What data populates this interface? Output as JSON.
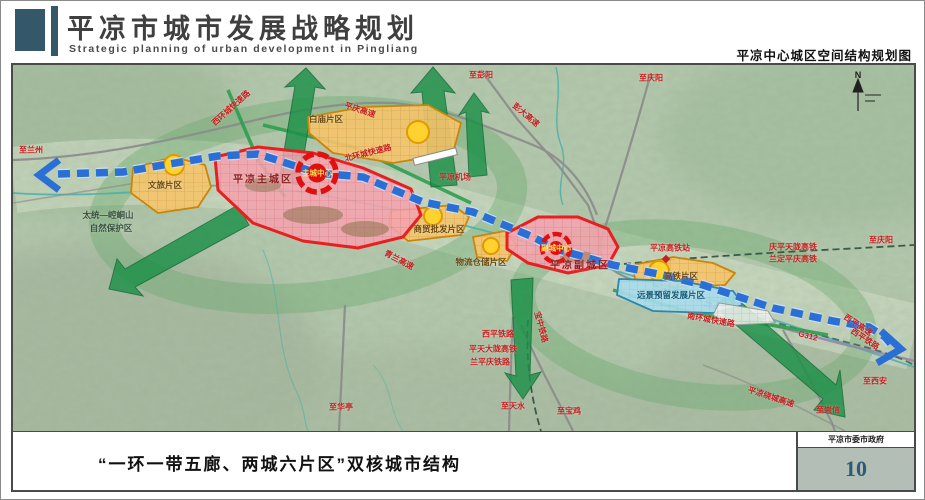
{
  "header": {
    "title": "平凉市城市发展战略规划",
    "subtitle": "Strategic planning of urban development in Pingliang",
    "map_title": "平凉中心城区空间结构规划图"
  },
  "footer": {
    "caption": "“一环一带五廊、两城六片区”双核城市结构",
    "organization": "平凉市委市政府",
    "page_number": "10"
  },
  "map": {
    "colors": {
      "header_accent": "#35576a",
      "terrain_green": "#b5c9ae",
      "corridor_green": "#1d9048",
      "axis_blue": "#2a6fd6",
      "core_red": "#e01010",
      "zone_orange": "#f6c46b",
      "zone_pink": "#f2a3ad",
      "zone_lightblue": "#a8dcec",
      "page_number_color": "#2c5a78"
    },
    "labels": [
      {
        "text": "至兰州",
        "x": 18,
        "y": 85,
        "cls": "r"
      },
      {
        "text": "至彭阳",
        "x": 468,
        "y": 10,
        "cls": "r"
      },
      {
        "text": "至庆阳",
        "x": 638,
        "y": 13,
        "cls": "r"
      },
      {
        "text": "至庆阳",
        "x": 868,
        "y": 175,
        "cls": "r"
      },
      {
        "text": "庆平天陇高铁",
        "x": 780,
        "y": 182,
        "cls": "r"
      },
      {
        "text": "兰定平庆高铁",
        "x": 780,
        "y": 194,
        "cls": "r"
      },
      {
        "text": "平凉高铁站",
        "x": 657,
        "y": 183,
        "cls": "r"
      },
      {
        "text": "平凉机场",
        "x": 442,
        "y": 112,
        "cls": "r"
      },
      {
        "text": "彭大高速",
        "x": 513,
        "y": 50,
        "cls": "r",
        "rot": 40
      },
      {
        "text": "平庆高速",
        "x": 347,
        "y": 45,
        "cls": "r",
        "rot": 18
      },
      {
        "text": "青兰高速",
        "x": 386,
        "y": 195,
        "cls": "r",
        "rot": 28
      },
      {
        "text": "西环城快速路",
        "x": 218,
        "y": 43,
        "cls": "r",
        "rot": -42
      },
      {
        "text": "北环城快速路",
        "x": 355,
        "y": 88,
        "cls": "r",
        "rot": -14
      },
      {
        "text": "南环城快速路",
        "x": 698,
        "y": 255,
        "cls": "r",
        "rot": 10
      },
      {
        "text": "G312",
        "x": 795,
        "y": 271,
        "cls": "r",
        "rot": 14
      },
      {
        "text": "西平高速",
        "x": 845,
        "y": 260,
        "cls": "r",
        "rot": 33
      },
      {
        "text": "西平铁路",
        "x": 852,
        "y": 274,
        "cls": "r",
        "rot": 33
      },
      {
        "text": "至西安",
        "x": 862,
        "y": 316,
        "cls": "r"
      },
      {
        "text": "至崇信",
        "x": 815,
        "y": 345,
        "cls": "r"
      },
      {
        "text": "平凉绕城高速",
        "x": 758,
        "y": 332,
        "cls": "r",
        "rot": 18
      },
      {
        "text": "至华亭",
        "x": 328,
        "y": 342,
        "cls": "r"
      },
      {
        "text": "至天水",
        "x": 500,
        "y": 341,
        "cls": "r"
      },
      {
        "text": "至宝鸡",
        "x": 556,
        "y": 346,
        "cls": "r"
      },
      {
        "text": "西平铁路",
        "x": 485,
        "y": 269,
        "cls": "r"
      },
      {
        "text": "平天大陇高铁",
        "x": 480,
        "y": 284,
        "cls": "r"
      },
      {
        "text": "兰平庆铁路",
        "x": 477,
        "y": 297,
        "cls": "r"
      },
      {
        "text": "宝中铁路",
        "x": 528,
        "y": 262,
        "cls": "r",
        "rot": 75
      },
      {
        "text": "太统—崆峒山",
        "x": 95,
        "y": 150,
        "cls": "d"
      },
      {
        "text": "自然保护区",
        "x": 98,
        "y": 163,
        "cls": "d"
      },
      {
        "text": "白庙片区",
        "x": 313,
        "y": 54,
        "cls": "z"
      },
      {
        "text": "文旅片区",
        "x": 152,
        "y": 120,
        "cls": "z"
      },
      {
        "text": "商贸批发片区",
        "x": 426,
        "y": 164,
        "cls": "z"
      },
      {
        "text": "物流仓储片区",
        "x": 468,
        "y": 197,
        "cls": "z"
      },
      {
        "text": "高铁片区",
        "x": 668,
        "y": 211,
        "cls": "z"
      },
      {
        "text": "远景预留发展片区",
        "x": 658,
        "y": 230,
        "cls": "zb"
      },
      {
        "text": "平凉主城区",
        "x": 250,
        "y": 113,
        "cls": "zc"
      },
      {
        "text": "平凉副城区",
        "x": 567,
        "y": 199,
        "cls": "zc"
      },
      {
        "text": "主城中心",
        "x": 304,
        "y": 108,
        "cls": "c"
      },
      {
        "text": "副城中心",
        "x": 543,
        "y": 183,
        "cls": "c"
      },
      {
        "text": "N",
        "x": 845,
        "y": 10,
        "cls": "n"
      }
    ]
  }
}
